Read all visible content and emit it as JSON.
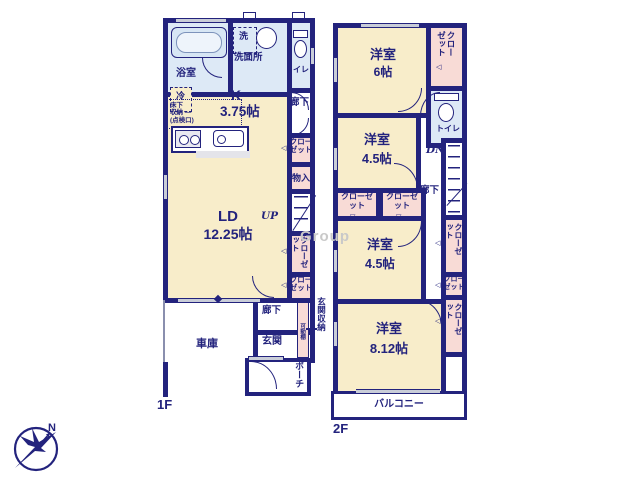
{
  "floor1": {
    "label": "1F",
    "bath": "浴室",
    "washroom": "洗面所",
    "washer": "洗",
    "toilet": "トイレ",
    "hall_upper": "廊下",
    "fridge": "冷",
    "kitchen_name": "K",
    "kitchen_size": "3.75帖",
    "underfloor": [
      "床下",
      "収納 ―",
      "(点検口)"
    ],
    "closet_a": "クローゼット",
    "storage": "物入",
    "stairs_up": "UP",
    "closet_b": "クローゼット",
    "closet_c": "クローゼット",
    "living_name": "LD",
    "living_size": "12.25帖",
    "garage": "車庫",
    "hall_lower": "廊下",
    "entrance": "玄関",
    "entrance_storage": "玄関収納",
    "shelf": "可動棚",
    "porch": "ポーチ"
  },
  "floor2": {
    "label": "2F",
    "room6_name": "洋室",
    "room6_size": "6帖",
    "closet_top": "クローゼット",
    "toilet": "トイレ",
    "room45a_name": "洋室",
    "room45a_size": "4.5帖",
    "stairs_down": "DN",
    "hall": "廊下",
    "closet_m1": "クローゼット",
    "closet_m2": "クローゼット",
    "room45b_name": "洋室",
    "room45b_size": "4.5帖",
    "closet_r1": "クローゼット",
    "closet_r2": "クローゼット",
    "closet_r3": "クローゼット",
    "room812_name": "洋室",
    "room812_size": "8.12帖",
    "balcony": "バルコニー"
  },
  "compass": {
    "north": "N"
  },
  "watermark": "Group",
  "colors": {
    "wall": "#23237d",
    "room_fill": "#f8edca",
    "closet_fill": "#f8dbd6",
    "wet_fill": "#dde9f6",
    "window_fill": "#c9cdd8",
    "watermark": "#c9c9c9"
  }
}
